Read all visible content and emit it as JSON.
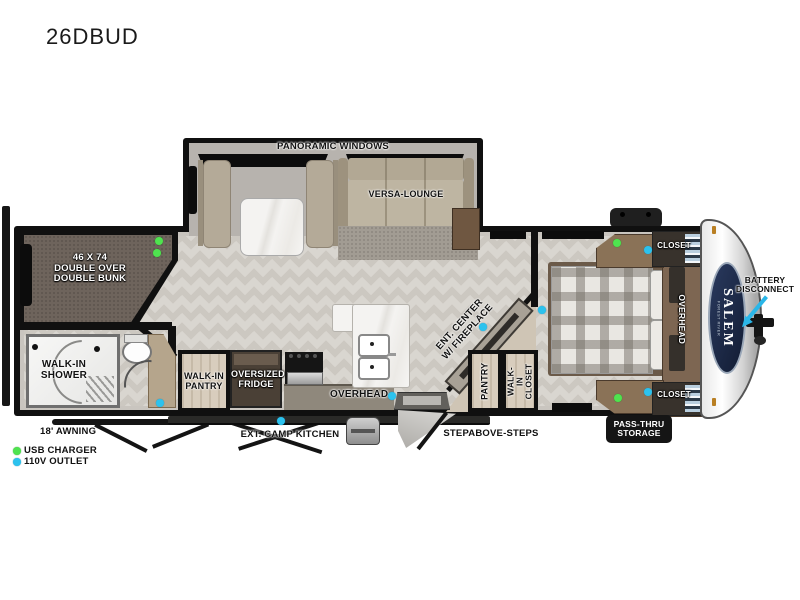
{
  "title": "26DBUD",
  "legend": {
    "usb_charger": "USB CHARGER",
    "outlet_110v": "110V OUTLET"
  },
  "exterior": {
    "awning": "18' AWNING",
    "ext_camp_kitchen": "EXT. CAMP KITCHEN",
    "stepabove_steps": "STEPABOVE-STEPS",
    "pass_thru_storage": "PASS-THRU\nSTORAGE",
    "battery_disconnect": "BATTERY\nDISCONNECT",
    "brand": "SALEM",
    "brand_sub": "FOREST RIVER"
  },
  "rooms": {
    "slide": {
      "panoramic_windows": "PANORAMIC WINDOWS",
      "versa_lounge": "VERSA-LOUNGE"
    },
    "bunk": "46 X 74\nDOUBLE OVER\nDOUBLE BUNK",
    "bathroom": {
      "walk_in_shower": "WALK-IN\nSHOWER"
    },
    "kitchen": {
      "walk_in_pantry": "WALK-IN\nPANTRY",
      "oversized_fridge": "OVERSIZED\nFRIDGE",
      "overhead": "OVERHEAD"
    },
    "living": {
      "ent_center": "ENT. CENTER\nW/ FIREPLACE"
    },
    "entry": {
      "pantry": "PANTRY",
      "walk_in_closet": "WALK-IN\nCLOSET"
    },
    "bedroom": {
      "closet_top": "CLOSET",
      "closet_bottom": "CLOSET",
      "overhead": "OVERHEAD"
    }
  },
  "colors": {
    "accent_green": "#4fe34f",
    "accent_blue": "#2cc2ee",
    "wall": "#101010",
    "logo_navy": "#1d2c4d"
  }
}
